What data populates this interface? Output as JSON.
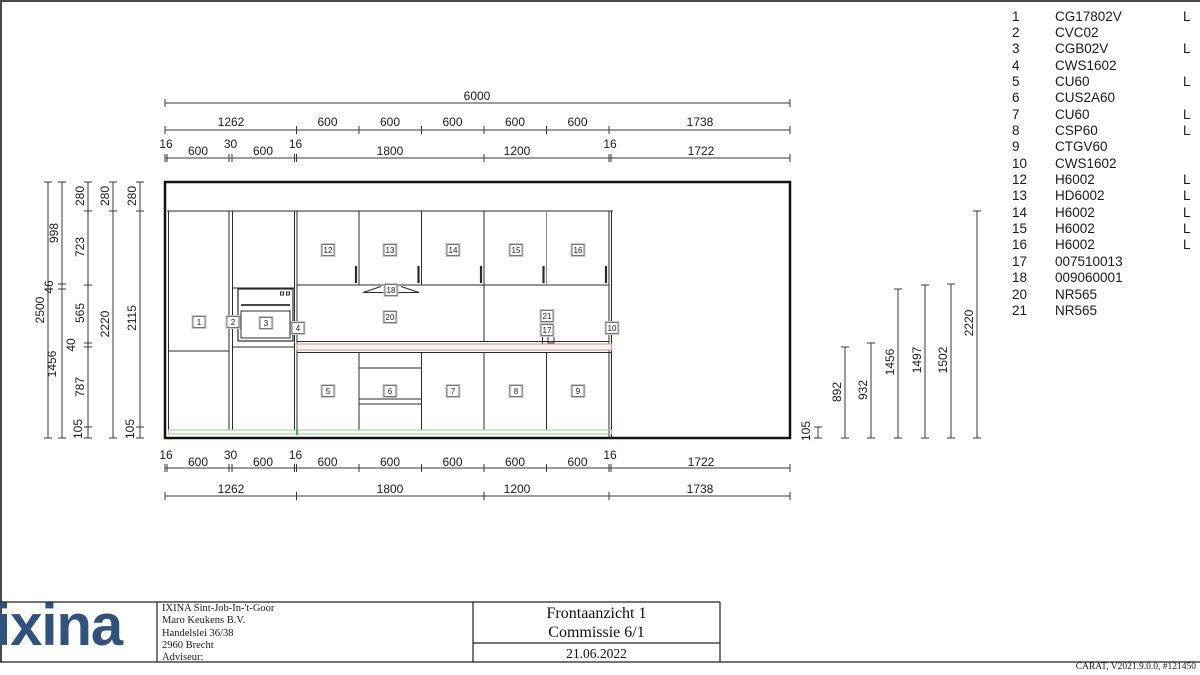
{
  "drawing": {
    "dim_top": {
      "total": "6000",
      "row2": [
        "1262",
        "600",
        "600",
        "600",
        "600",
        "600",
        "1738"
      ],
      "row3": [
        "16",
        "600",
        "30",
        "600",
        "16",
        "1800",
        "1200",
        "16",
        "1722"
      ]
    },
    "dim_bottom": {
      "row1": [
        "16",
        "600",
        "30",
        "600",
        "16",
        "600",
        "600",
        "600",
        "600",
        "600",
        "16",
        "1722"
      ],
      "row2": [
        "1262",
        "1800",
        "1200",
        "1738"
      ]
    },
    "dim_left": {
      "total": "2500",
      "col_b": [
        "998",
        "46",
        "1456"
      ],
      "col_c": [
        "280",
        "723",
        "565",
        "40",
        "787",
        "105"
      ],
      "col_d": [
        "280",
        "2220"
      ],
      "col_e": [
        "280",
        "2115",
        "105"
      ]
    },
    "dim_right": [
      "105",
      "892",
      "932",
      "1456",
      "1497",
      "1502",
      "2220"
    ],
    "cabinet_tags": [
      "1",
      "2",
      "3",
      "4",
      "5",
      "6",
      "7",
      "8",
      "9",
      "10",
      "12",
      "13",
      "14",
      "15",
      "16",
      "17",
      "18",
      "20",
      "21"
    ],
    "colors": {
      "line": "#2b2b2b",
      "plinth_green": "#97cd97",
      "plinth_green_bright": "#3fba3f",
      "worktop_pink": "#d2a49b",
      "logo_blue": "#2f527e"
    }
  },
  "parts_list": {
    "items": [
      {
        "no": "1",
        "code": "CG17802V",
        "flag": "L"
      },
      {
        "no": "2",
        "code": "CVC02",
        "flag": ""
      },
      {
        "no": "3",
        "code": "CGB02V",
        "flag": "L"
      },
      {
        "no": "4",
        "code": "CWS1602",
        "flag": ""
      },
      {
        "no": "5",
        "code": "CU60",
        "flag": "L"
      },
      {
        "no": "6",
        "code": "CUS2A60",
        "flag": ""
      },
      {
        "no": "7",
        "code": "CU60",
        "flag": "L"
      },
      {
        "no": "8",
        "code": "CSP60",
        "flag": "L"
      },
      {
        "no": "9",
        "code": "CTGV60",
        "flag": ""
      },
      {
        "no": "10",
        "code": "CWS1602",
        "flag": ""
      },
      {
        "no": "12",
        "code": "H6002",
        "flag": "L"
      },
      {
        "no": "13",
        "code": "HD6002",
        "flag": "L"
      },
      {
        "no": "14",
        "code": "H6002",
        "flag": "L"
      },
      {
        "no": "15",
        "code": "H6002",
        "flag": "L"
      },
      {
        "no": "16",
        "code": "H6002",
        "flag": "L"
      },
      {
        "no": "17",
        "code": "007510013",
        "flag": ""
      },
      {
        "no": "18",
        "code": "009060001",
        "flag": ""
      },
      {
        "no": "20",
        "code": "NR565",
        "flag": ""
      },
      {
        "no": "21",
        "code": "NR565",
        "flag": ""
      }
    ]
  },
  "title_block": {
    "logo_text": "ixina",
    "address_lines": [
      "IXINA Sint-Job-In-'t-Goor",
      "Maro Keukens B.V.",
      "Handelslei 36/38",
      "2960 Brecht",
      "Adviseur:"
    ],
    "title_line1": "Frontaanzicht 1",
    "title_line2": "Commissie 6/1",
    "date": "21.06.2022",
    "footer_right": "CARAT, V2021.9.0.0, #121450"
  }
}
